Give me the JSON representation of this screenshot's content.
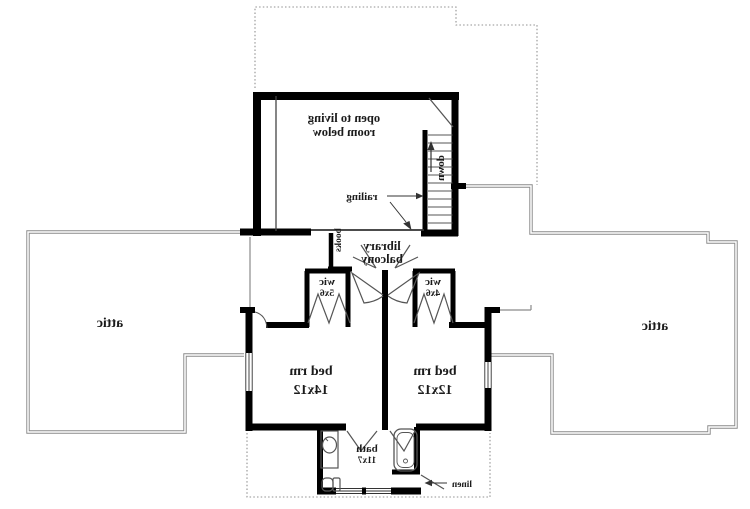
{
  "colors": {
    "wall": "#000000",
    "attic_outline": "#8a8a8a",
    "dotted_overhang": "#909090",
    "detail_stroke": "#555555",
    "text": "#1b1b1b"
  },
  "labels": {
    "attic_left": "attic",
    "attic_right": "attic",
    "open_living_1": "open to living",
    "open_living_2": "room below",
    "railing": "railing",
    "down": "down",
    "library_1": "library",
    "library_2": "balcony",
    "books": "books",
    "wic_left_1": "wic",
    "wic_left_2": "5x6",
    "wic_right_1": "wic",
    "wic_right_2": "4x6",
    "bed_left_1": "bed rm",
    "bed_left_2": "14x12",
    "bed_right_1": "bed rm",
    "bed_right_2": "12x12",
    "bath_1": "bath",
    "bath_2": "11x7",
    "linen": "linen"
  }
}
